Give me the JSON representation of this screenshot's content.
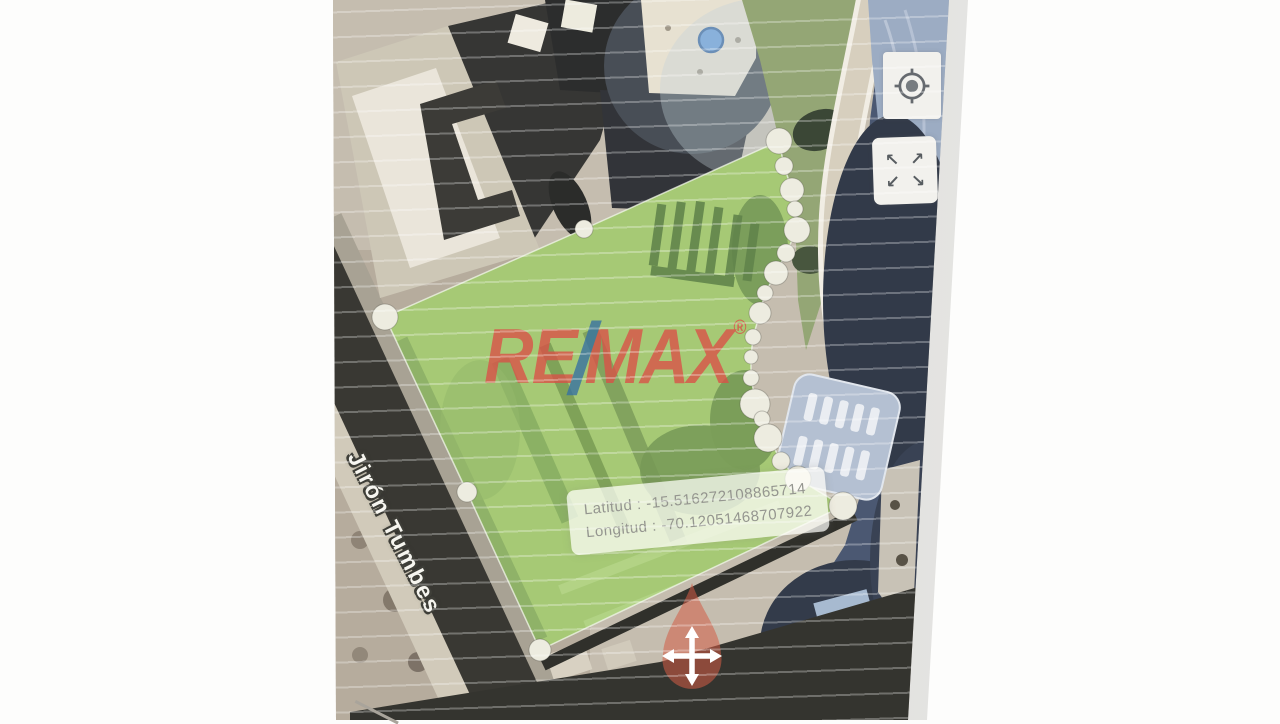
{
  "watermark": {
    "re": "RE",
    "slash": "/",
    "max": "MAX",
    "registered": "®"
  },
  "tooltip": {
    "latitude_label": "Latitud",
    "separator": ":",
    "latitude_value": "-15.516272108865714",
    "longitude_label": "Longitud",
    "longitude_value": "-70.12051468707922"
  },
  "street": {
    "name": "Jirón Tumbes"
  },
  "controls": {
    "fullscreen_glyphs": {
      "tl": "↖",
      "tr": "↗",
      "bl": "↙",
      "br": "↘"
    }
  },
  "colors": {
    "remax_red": "#d8493f",
    "remax_blue": "#2e6b9d",
    "polygon_fill": "#98c164",
    "vertex_dot": "#edebdd",
    "marker_blue": "#7cacdf",
    "pan_marker_red": "rgba(209,84,60,0.55)",
    "street_dark": "#2b2a24",
    "page_background": "#fdfdfc"
  }
}
